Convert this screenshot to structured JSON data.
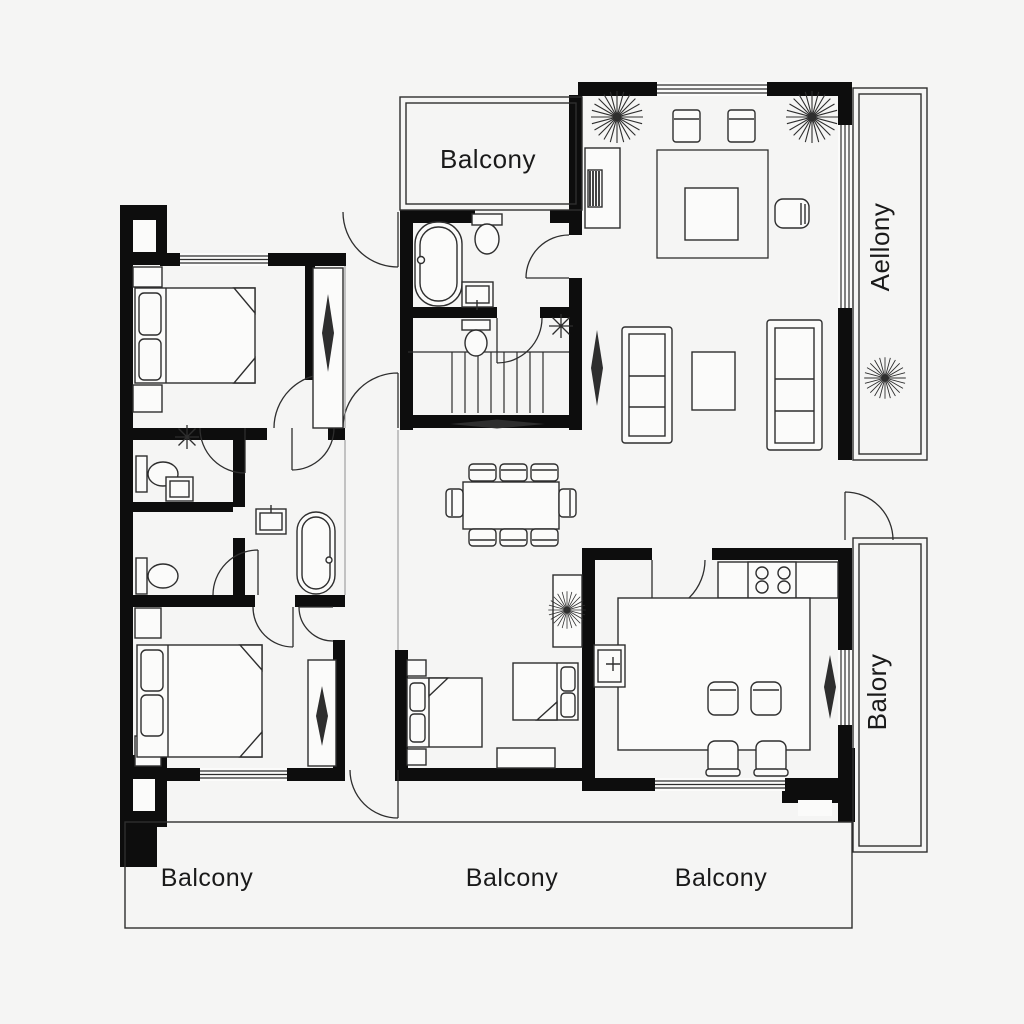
{
  "colors": {
    "wall": "#0d0d0d",
    "line": "#2e2e2e",
    "soft": "#8f8f8f",
    "paper": "#fbfbfa",
    "background": "#f5f5f4",
    "text": "#1a1a1a"
  },
  "labels": {
    "balcony_top": "Balcony",
    "balcony_right_upper": "Aellony",
    "balcony_right_lower": "Balory",
    "balcony_bottom_left": "Balcony",
    "balcony_bottom_center": "Balcony",
    "balcony_bottom_right": "Balcony"
  }
}
